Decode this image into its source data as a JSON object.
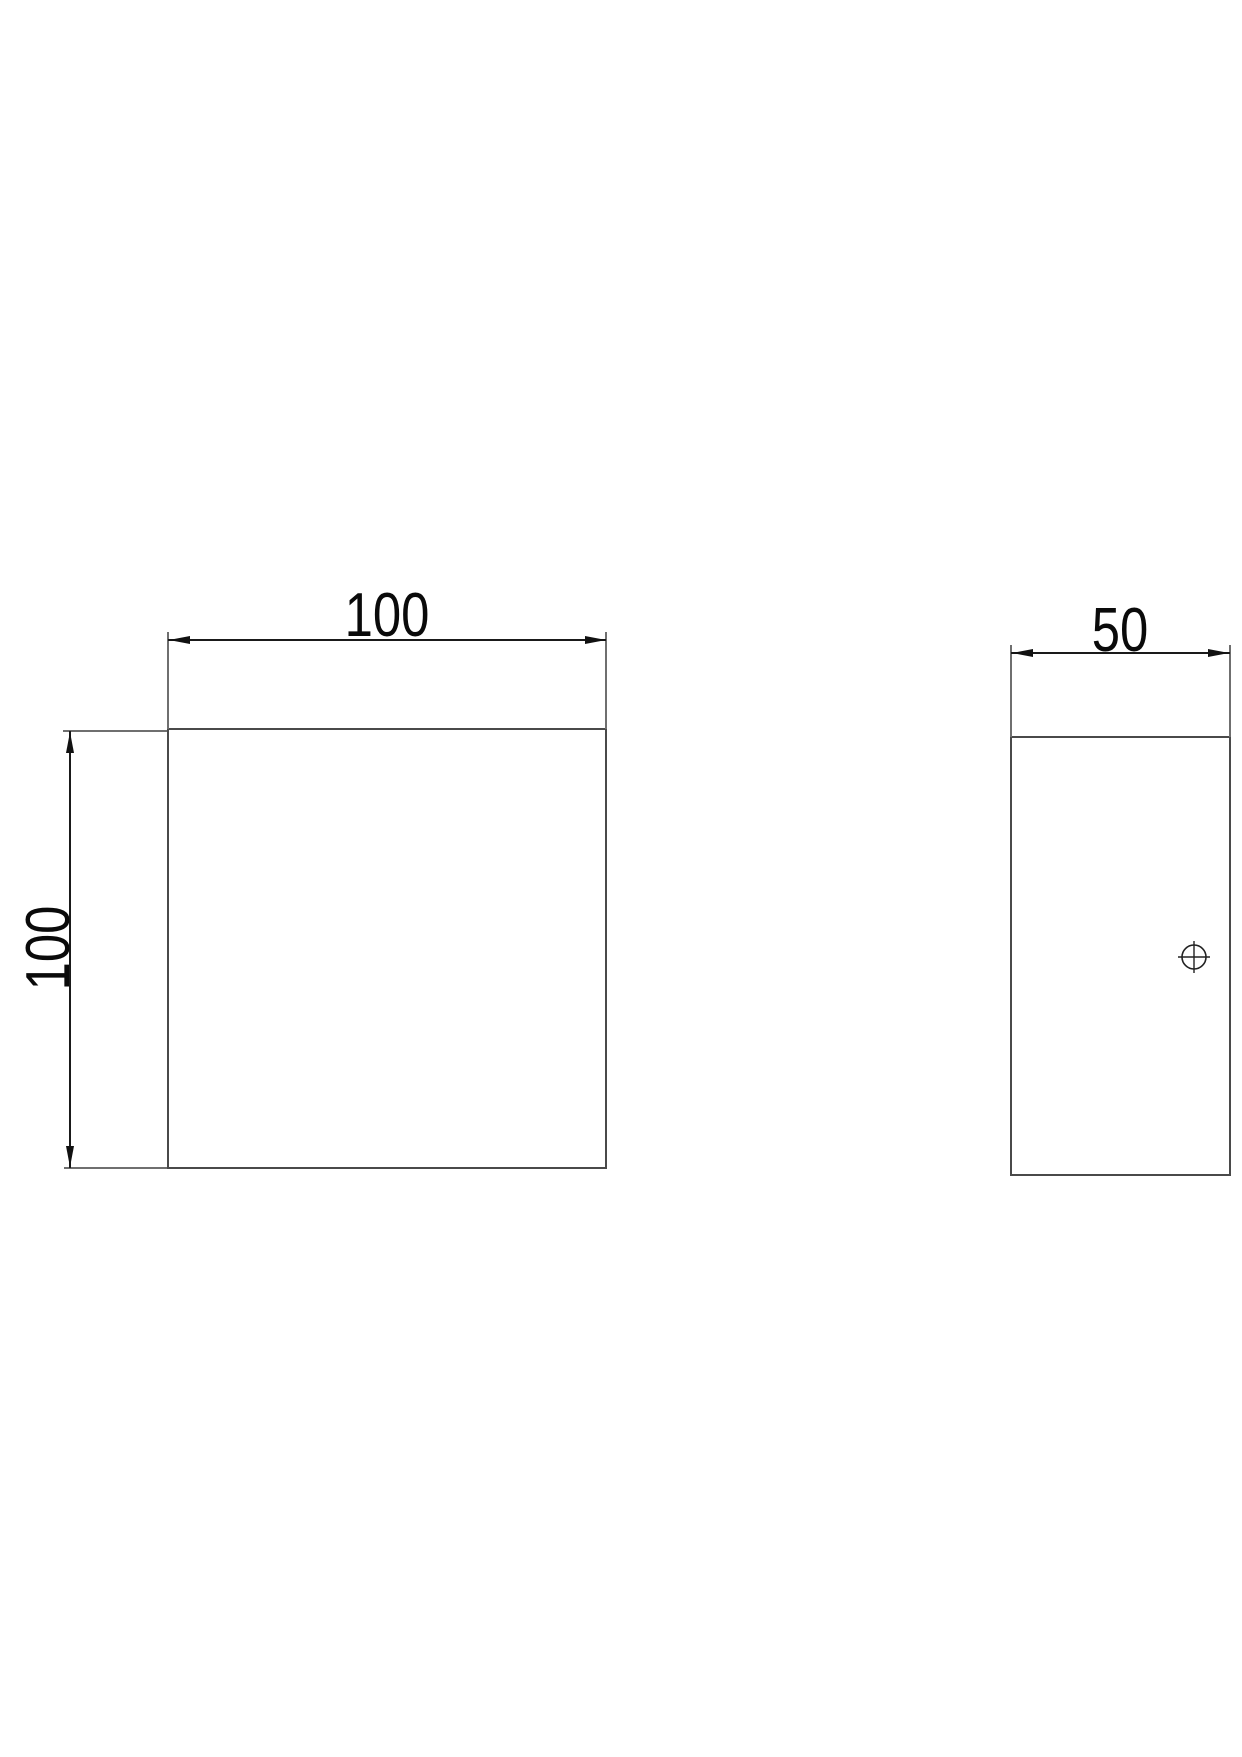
{
  "drawing": {
    "type": "engineering-drawing",
    "background": "#ffffff",
    "front_view": {
      "label": "front view",
      "shape": "square",
      "width_dim": "100",
      "height_dim": "100"
    },
    "side_view": {
      "label": "side view",
      "shape": "rectangle",
      "width_dim": "50",
      "hole_marker_icon": "crosshair-circle"
    },
    "colors": {
      "object_line": "#4a4a4a",
      "extension_line": "#6f6f6f",
      "dimension_line": "#1a1a1a",
      "dimension_text": "#0a0a0a"
    }
  }
}
